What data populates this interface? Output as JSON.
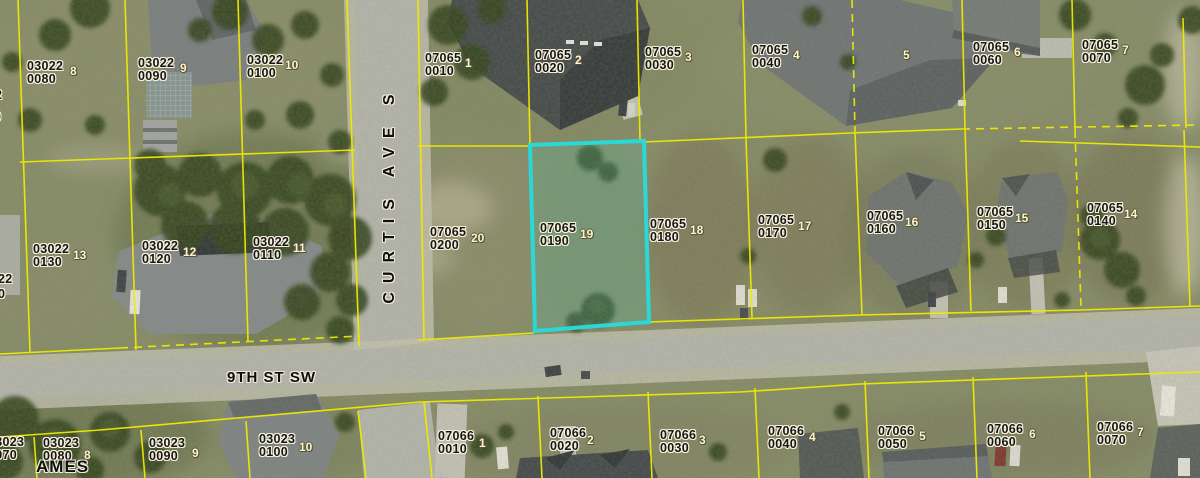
{
  "map_type": "aerial-parcel-map",
  "colors": {
    "parcel_line": "#eeea00",
    "highlight_outline": "#2bd8d8",
    "label_text": "#161616",
    "lot_number_text": "#fdf4cd"
  },
  "highlighted_parcel": {
    "strap1": "07065",
    "strap2": "0190",
    "lot": "19"
  },
  "streets": [
    {
      "name": "CURTIS AVE S",
      "orientation": "vertical",
      "x": 381,
      "y": 332
    },
    {
      "name": "9TH ST SW",
      "orientation": "horizontal",
      "x": 227,
      "y": 369
    }
  ],
  "parcels": [
    {
      "strap1": "03022",
      "strap2": "0080",
      "lot": "8",
      "x": 27,
      "y": 60,
      "lx": 70,
      "ly": 64
    },
    {
      "strap1": "03022",
      "strap2": "0090",
      "lot": "9",
      "x": 138,
      "y": 57,
      "lx": 180,
      "ly": 61
    },
    {
      "strap1": "03022",
      "strap2": "0100",
      "lot": "10",
      "x": 247,
      "y": 54,
      "lx": 285,
      "ly": 58
    },
    {
      "strap1": "07065",
      "strap2": "0010",
      "lot": "1",
      "x": 425,
      "y": 52,
      "lx": 465,
      "ly": 56
    },
    {
      "strap1": "07065",
      "strap2": "0020",
      "lot": "2",
      "x": 535,
      "y": 49,
      "lx": 575,
      "ly": 53
    },
    {
      "strap1": "07065",
      "strap2": "0030",
      "lot": "3",
      "x": 645,
      "y": 46,
      "lx": 685,
      "ly": 50
    },
    {
      "strap1": "07065",
      "strap2": "0040",
      "lot": "4",
      "x": 752,
      "y": 44,
      "lx": 793,
      "ly": 48
    },
    {
      "strap1": "07065",
      "strap2": "0060",
      "lot": "6",
      "x": 973,
      "y": 41,
      "lx": 1014,
      "ly": 45
    },
    {
      "strap1": "07065",
      "strap2": "0070",
      "lot": "7",
      "x": 1082,
      "y": 39,
      "lx": 1122,
      "ly": 43
    },
    {
      "strap1": "03022",
      "strap2": "0130",
      "lot": "13",
      "x": 33,
      "y": 243,
      "lx": 73,
      "ly": 248
    },
    {
      "strap1": "03022",
      "strap2": "0120",
      "lot": "12",
      "x": 142,
      "y": 240,
      "lx": 183,
      "ly": 245
    },
    {
      "strap1": "03022",
      "strap2": "0110",
      "lot": "11",
      "x": 253,
      "y": 236,
      "lx": 293,
      "ly": 241
    },
    {
      "strap1": "07065",
      "strap2": "0200",
      "lot": "20",
      "x": 430,
      "y": 226,
      "lx": 471,
      "ly": 231
    },
    {
      "strap1": "07065",
      "strap2": "0190",
      "lot": "19",
      "x": 540,
      "y": 222,
      "lx": 580,
      "ly": 227
    },
    {
      "strap1": "07065",
      "strap2": "0180",
      "lot": "18",
      "x": 650,
      "y": 218,
      "lx": 690,
      "ly": 223
    },
    {
      "strap1": "07065",
      "strap2": "0170",
      "lot": "17",
      "x": 758,
      "y": 214,
      "lx": 798,
      "ly": 219
    },
    {
      "strap1": "07065",
      "strap2": "0160",
      "lot": "16",
      "x": 867,
      "y": 210,
      "lx": 905,
      "ly": 215
    },
    {
      "strap1": "07065",
      "strap2": "0150",
      "lot": "15",
      "x": 977,
      "y": 206,
      "lx": 1015,
      "ly": 211
    },
    {
      "strap1": "07065",
      "strap2": "0140",
      "lot": "14",
      "x": 1087,
      "y": 202,
      "lx": 1124,
      "ly": 207
    },
    {
      "strap1": "03023",
      "strap2": "0070",
      "lot": "",
      "x": -12,
      "y": 436,
      "lx": 0,
      "ly": 0
    },
    {
      "strap1": "03023",
      "strap2": "0080",
      "lot": "8",
      "x": 43,
      "y": 437,
      "lx": 84,
      "ly": 448
    },
    {
      "strap1": "03023",
      "strap2": "0090",
      "lot": "9",
      "x": 149,
      "y": 437,
      "lx": 192,
      "ly": 446
    },
    {
      "strap1": "03023",
      "strap2": "0100",
      "lot": "10",
      "x": 259,
      "y": 433,
      "lx": 299,
      "ly": 440
    },
    {
      "strap1": "07066",
      "strap2": "0010",
      "lot": "1",
      "x": 438,
      "y": 430,
      "lx": 479,
      "ly": 436
    },
    {
      "strap1": "07066",
      "strap2": "0020",
      "lot": "2",
      "x": 550,
      "y": 427,
      "lx": 587,
      "ly": 433
    },
    {
      "strap1": "07066",
      "strap2": "0030",
      "lot": "3",
      "x": 660,
      "y": 429,
      "lx": 699,
      "ly": 433
    },
    {
      "strap1": "07066",
      "strap2": "0040",
      "lot": "4",
      "x": 768,
      "y": 425,
      "lx": 809,
      "ly": 430
    },
    {
      "strap1": "07066",
      "strap2": "0050",
      "lot": "5",
      "x": 878,
      "y": 425,
      "lx": 919,
      "ly": 429
    },
    {
      "strap1": "07066",
      "strap2": "0060",
      "lot": "6",
      "x": 987,
      "y": 423,
      "lx": 1029,
      "ly": 427
    },
    {
      "strap1": "07066",
      "strap2": "0070",
      "lot": "7",
      "x": 1097,
      "y": 421,
      "lx": 1137,
      "ly": 425
    }
  ],
  "extra_lots": [
    {
      "lot": "5",
      "x": 903,
      "y": 48
    }
  ],
  "partials": [
    {
      "text": "2",
      "x": -5,
      "y": 89
    },
    {
      "text": "0",
      "x": -6,
      "y": 111
    },
    {
      "text": "22",
      "x": -2,
      "y": 273
    },
    {
      "text": "0",
      "x": -2,
      "y": 288
    },
    {
      "text": "AMES",
      "x": 36,
      "y": 457,
      "kind": "street"
    }
  ]
}
